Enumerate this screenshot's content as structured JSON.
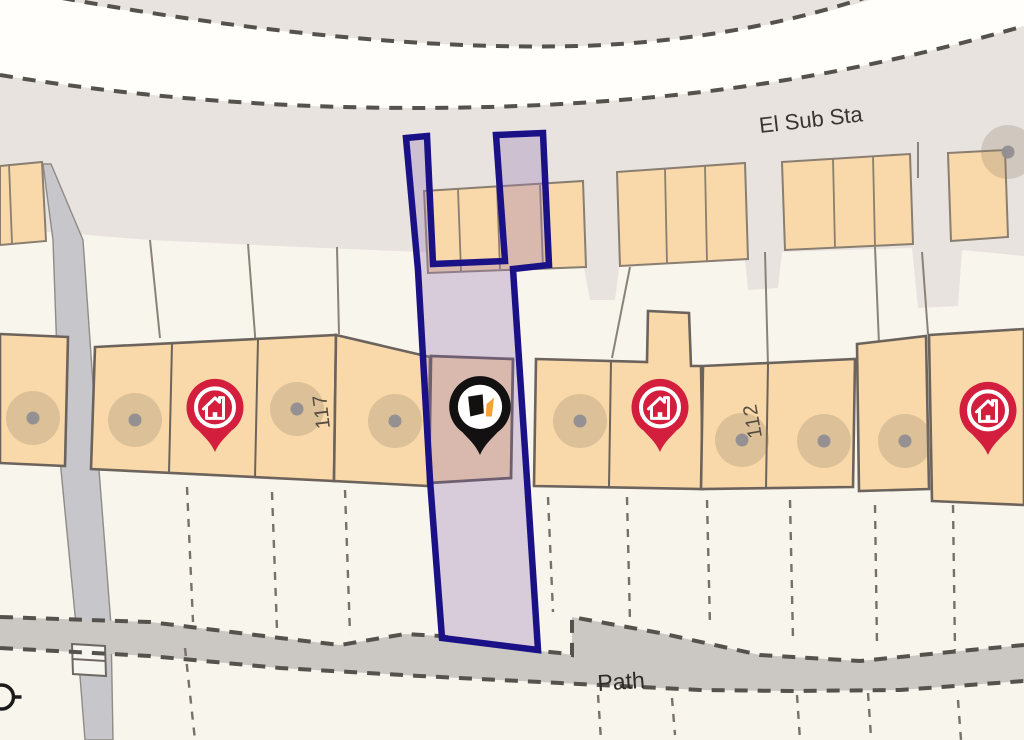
{
  "map": {
    "labels": {
      "substation": "El Sub Sta",
      "footpath": "Path",
      "house_117": "117",
      "house_112": "112"
    },
    "colors": {
      "background": "#f8f5ec",
      "road_fill": "#fffefa",
      "verge_fill": "#e8e3de",
      "footpath_fill": "#cbc8c4",
      "driveway_fill": "#c7c7cb",
      "building_fill": "#f9d9a9",
      "building_stroke": "#8a7e70",
      "building_stroke_dark": "#6b635c",
      "parcel_line": "#8a8379",
      "boundary_dash": "#55524d",
      "selected_plot_fill": "#9878b6",
      "selected_plot_stroke": "#1b1187",
      "pin_red": "#d31f3d",
      "pin_black": "#121010",
      "logo_orange": "#f2a138",
      "label_text": "#3a3530"
    },
    "selected_pin": {
      "transform": "translate(480,455)"
    },
    "red_pins": [
      {
        "transform": "translate(215,452)"
      },
      {
        "transform": "translate(660,452)"
      },
      {
        "transform": "translate(988,455)"
      }
    ],
    "address_dots": [
      "translate(33,418)",
      "translate(135,420)",
      "translate(297,409)",
      "translate(395,421)",
      "translate(580,421)",
      "translate(742,440)",
      "translate(824,441)",
      "translate(905,441)",
      "translate(1008,152)"
    ]
  }
}
